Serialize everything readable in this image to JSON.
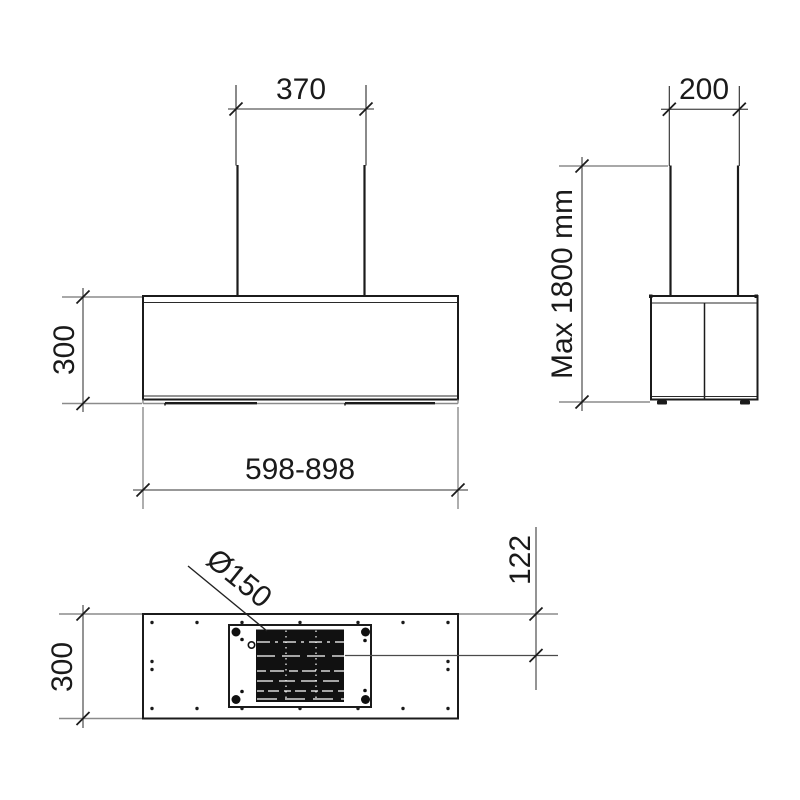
{
  "drawing": {
    "front_view": {
      "chimney_width": "370",
      "body_height": "300",
      "body_width_range": "598-898"
    },
    "side_view": {
      "chimney_depth": "200",
      "max_height": "Max 1800 mm"
    },
    "plan_view": {
      "duct_diameter": "Ø150",
      "duct_center_offset": "122",
      "body_depth": "300"
    },
    "colors": {
      "outline": "#1b1b1b",
      "dimension_line": "#5a5a5a",
      "extension_line": "#8b8b8b",
      "filter_fill": "#111111",
      "background": "#ffffff"
    }
  }
}
